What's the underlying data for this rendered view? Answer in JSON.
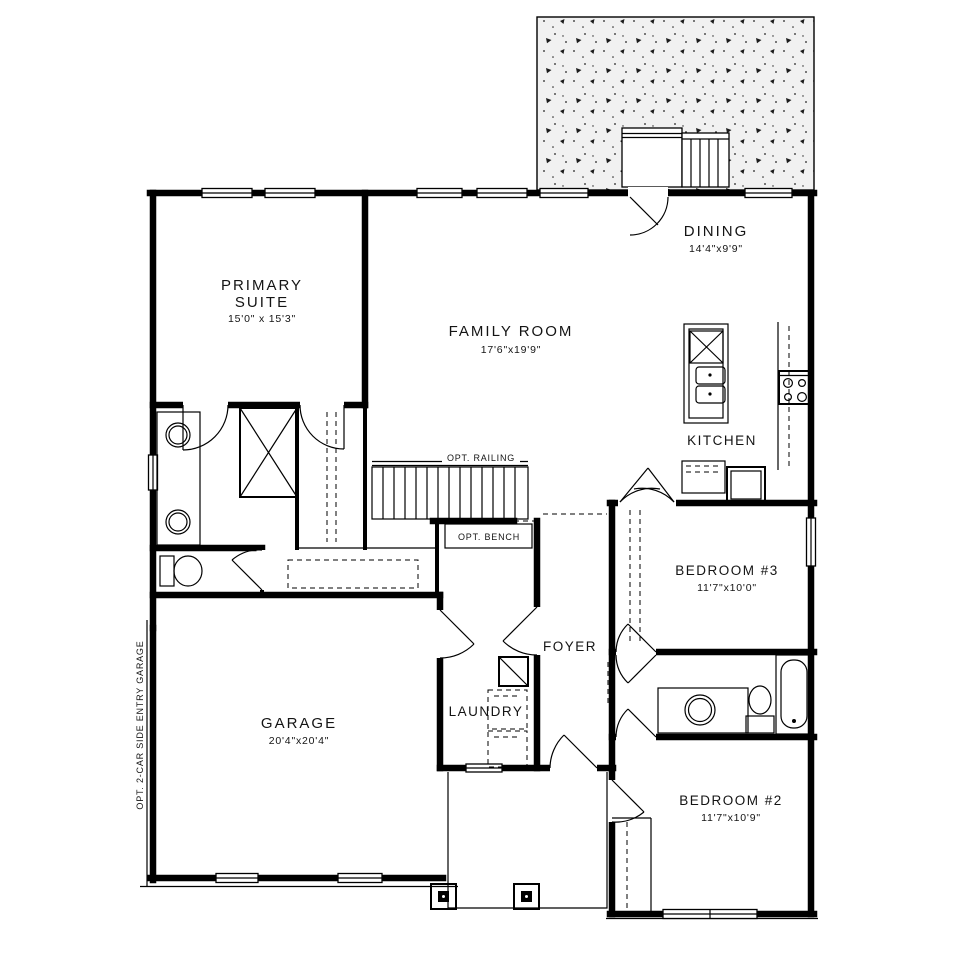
{
  "page": {
    "background": "#ffffff",
    "line_color": "#000000",
    "patio_fill": "#f1f1f1"
  },
  "rooms": {
    "primary_suite": {
      "label_line1": "PRIMARY",
      "label_line2": "SUITE",
      "dims": "15'0\" x 15'3\""
    },
    "family_room": {
      "label": "FAMILY ROOM",
      "dims": "17'6\"x19'9\""
    },
    "dining": {
      "label": "DINING",
      "dims": "14'4\"x9'9\""
    },
    "kitchen": {
      "label": "KITCHEN"
    },
    "bedroom_3": {
      "label": "BEDROOM #3",
      "dims": "11'7\"x10'0\""
    },
    "bedroom_2": {
      "label": "BEDROOM #2",
      "dims": "11'7\"x10'9\""
    },
    "garage": {
      "label": "GARAGE",
      "dims": "20'4\"x20'4\""
    },
    "laundry": {
      "label": "LAUNDRY"
    },
    "foyer": {
      "label": "FOYER"
    }
  },
  "annotations": {
    "opt_railing": "OPT. RAILING",
    "opt_bench": "OPT. BENCH",
    "opt_side_garage": "OPT. 2-CAR SIDE ENTRY GARAGE"
  }
}
